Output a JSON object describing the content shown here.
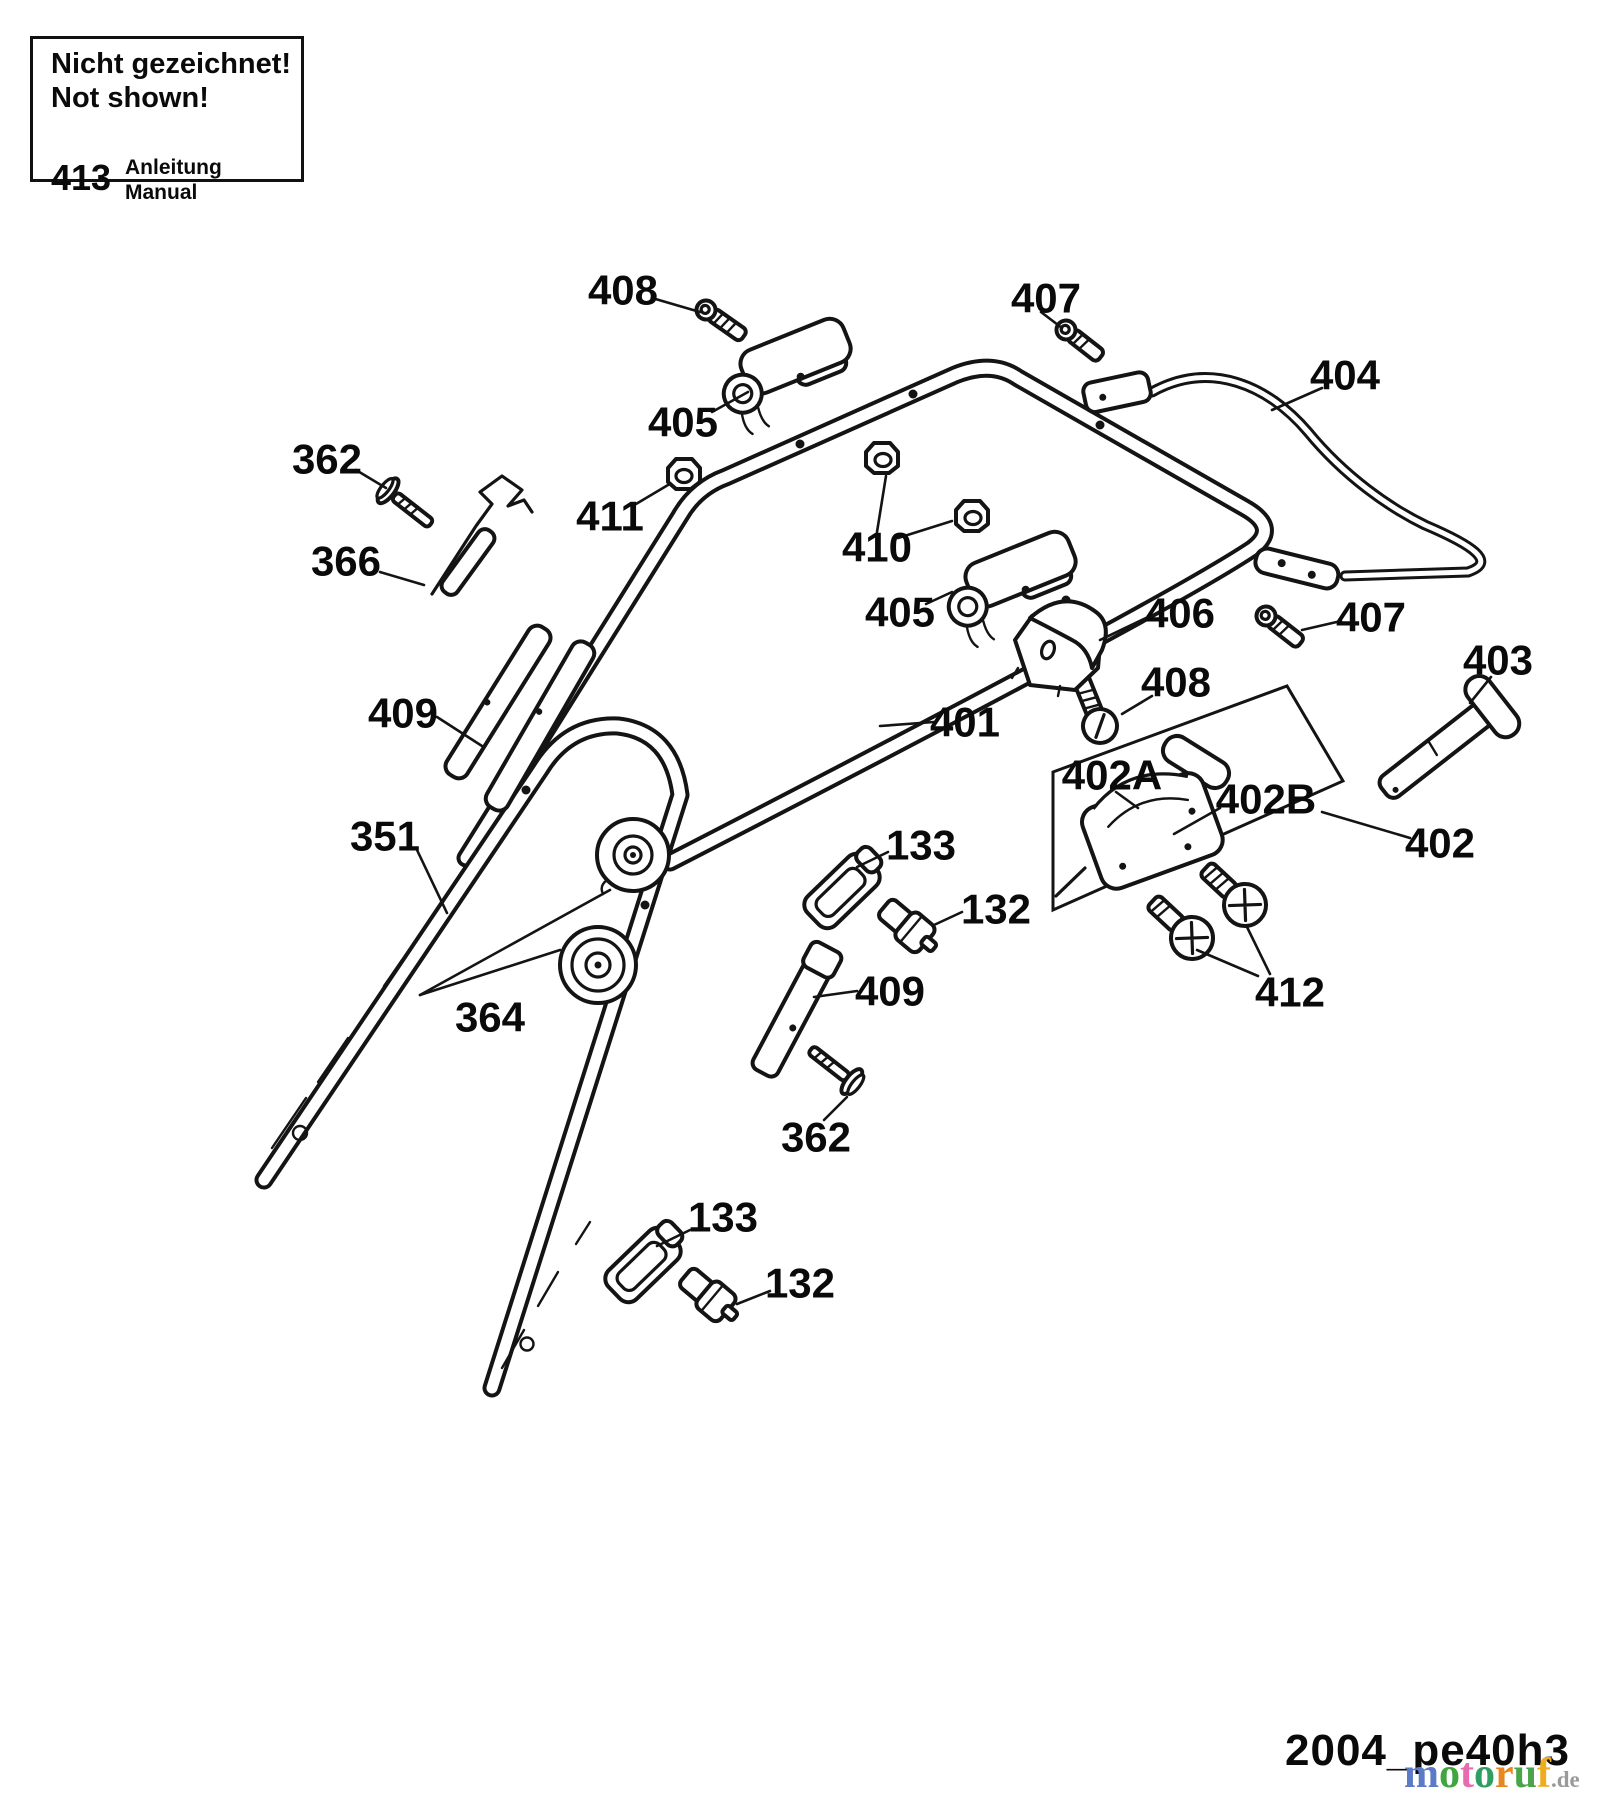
{
  "notice_box": {
    "line1": "Nicht gezeichnet!",
    "line2": "Not shown!",
    "ref": "413",
    "name_de": "Anleitung",
    "name_en": "Manual"
  },
  "diagram_id": "2004_pe40h3",
  "colors": {
    "ink": "#141414",
    "label": "#0a0a0a",
    "watermark_suffix": "#9a9a9a"
  },
  "watermark": {
    "letters": [
      {
        "ch": "m",
        "color": "#5b7bc7"
      },
      {
        "ch": "o",
        "color": "#3fa63f"
      },
      {
        "ch": "t",
        "color": "#e86bb0"
      },
      {
        "ch": "o",
        "color": "#2f9e63"
      },
      {
        "ch": "r",
        "color": "#e8861f"
      },
      {
        "ch": "u",
        "color": "#4aa44a"
      },
      {
        "ch": "f",
        "color": "#eead1f"
      }
    ],
    "suffix": ".de"
  },
  "labels": [
    {
      "id": "408",
      "x": 623,
      "y": 290
    },
    {
      "id": "405",
      "x": 683,
      "y": 422
    },
    {
      "id": "407",
      "x": 1046,
      "y": 298
    },
    {
      "id": "404",
      "x": 1345,
      "y": 375
    },
    {
      "id": "362",
      "x": 327,
      "y": 459
    },
    {
      "id": "366",
      "x": 346,
      "y": 561
    },
    {
      "id": "411",
      "x": 610,
      "y": 516
    },
    {
      "id": "410",
      "x": 877,
      "y": 547
    },
    {
      "id": "405",
      "x": 900,
      "y": 612
    },
    {
      "id": "406",
      "x": 1180,
      "y": 613
    },
    {
      "id": "407",
      "x": 1371,
      "y": 617
    },
    {
      "id": "403",
      "x": 1498,
      "y": 660
    },
    {
      "id": "401",
      "x": 965,
      "y": 722
    },
    {
      "id": "408",
      "x": 1176,
      "y": 682
    },
    {
      "id": "402A",
      "x": 1112,
      "y": 775
    },
    {
      "id": "402B",
      "x": 1266,
      "y": 799
    },
    {
      "id": "402",
      "x": 1440,
      "y": 843
    },
    {
      "id": "409",
      "x": 403,
      "y": 713
    },
    {
      "id": "351",
      "x": 385,
      "y": 836
    },
    {
      "id": "364",
      "x": 490,
      "y": 1017
    },
    {
      "id": "133",
      "x": 921,
      "y": 845
    },
    {
      "id": "132",
      "x": 996,
      "y": 909
    },
    {
      "id": "409",
      "x": 890,
      "y": 991
    },
    {
      "id": "412",
      "x": 1290,
      "y": 992
    },
    {
      "id": "362",
      "x": 816,
      "y": 1137
    },
    {
      "id": "133",
      "x": 723,
      "y": 1217
    },
    {
      "id": "132",
      "x": 800,
      "y": 1283
    }
  ]
}
